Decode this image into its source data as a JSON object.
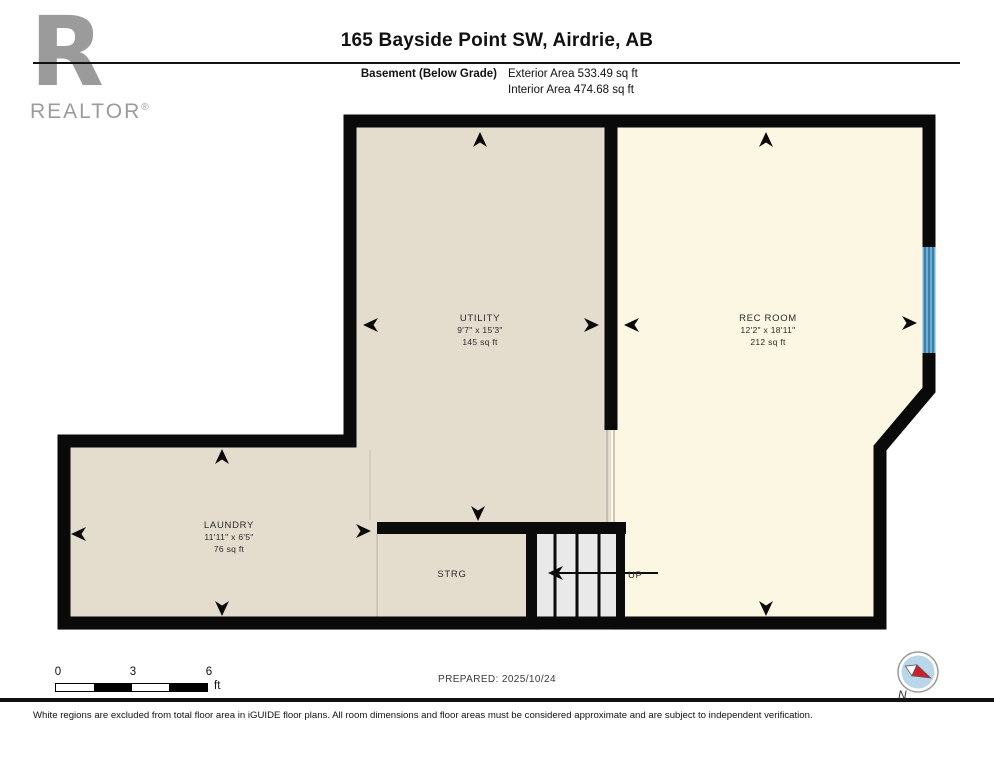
{
  "header": {
    "brand_letter": "R",
    "brand_name": "REALTOR",
    "brand_reg": "®",
    "title": "165 Bayside Point SW, Airdrie, AB",
    "floor_label": "Basement (Below Grade)",
    "exterior_area": "Exterior Area 533.49 sq ft",
    "interior_area": "Interior Area 474.68 sq ft"
  },
  "floorplan": {
    "rooms": [
      {
        "name": "UTILITY",
        "dims": "9'7\" x 15'3\"",
        "area": "145 sq ft"
      },
      {
        "name": "REC ROOM",
        "dims": "12'2\" x 18'11\"",
        "area": "212 sq ft"
      },
      {
        "name": "LAUNDRY",
        "dims": "11'11\" x 6'5\"",
        "area": "76 sq ft"
      },
      {
        "name": "STRG"
      }
    ],
    "stairs": {
      "direction_label": "UP"
    },
    "colors": {
      "room_fill": "#e4dccc",
      "excluded_fill": "#fbf7e3",
      "stairs_fill": "#e9e9e9",
      "wall": "#0a0a0a",
      "window": "#68b0d8"
    }
  },
  "footer": {
    "scale": {
      "ticks": [
        "0",
        "3",
        "6"
      ],
      "unit": "ft"
    },
    "prepared": "PREPARED: 2025/10/24",
    "compass_label": "N",
    "disclaimer": "White regions are excluded from total floor area in iGUIDE floor plans. All room dimensions and floor areas must be considered approximate and are subject to independent verification."
  }
}
